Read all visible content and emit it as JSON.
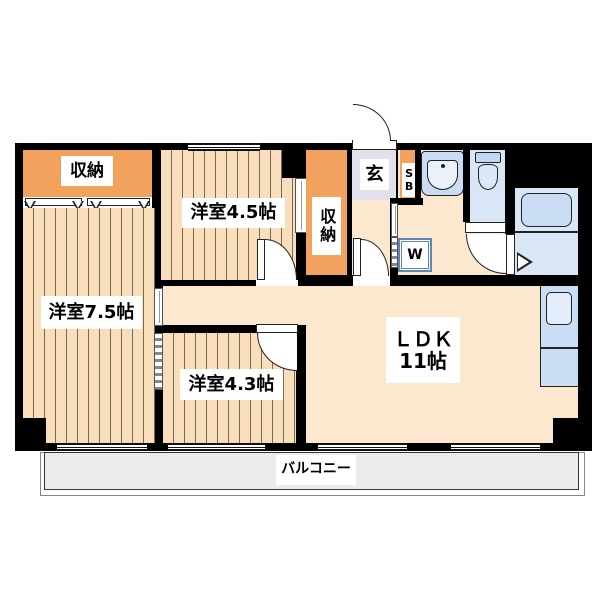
{
  "colors": {
    "wall": "#000000",
    "wood_floor": "#F8DEBB",
    "wood_floor_line": "#7A6A58",
    "ldk_floor": "#FBE8CE",
    "closet_orange": "#F2A25C",
    "entrance_tile": "#E2E1EB",
    "balcony_gray": "#ECECEC",
    "water_blue": "#D8E6F6",
    "fixture_blue": "#C9DCF4",
    "kitchen_blue": "#C9DDF5"
  },
  "rooms": {
    "closet_main": {
      "label": "収納"
    },
    "bedroom_45": {
      "label": "洋室4.5帖"
    },
    "closet_hall": {
      "label": "収納"
    },
    "entrance": {
      "label": "玄"
    },
    "shoe_box": {
      "label": "SB"
    },
    "washing_machine": {
      "label": "W"
    },
    "bedroom_75": {
      "label": "洋室7.5帖"
    },
    "bedroom_43": {
      "label": "洋室4.3帖"
    },
    "ldk": {
      "label": "ＬＤＫ",
      "size": "11帖"
    },
    "balcony": {
      "label": "バルコニー"
    }
  }
}
